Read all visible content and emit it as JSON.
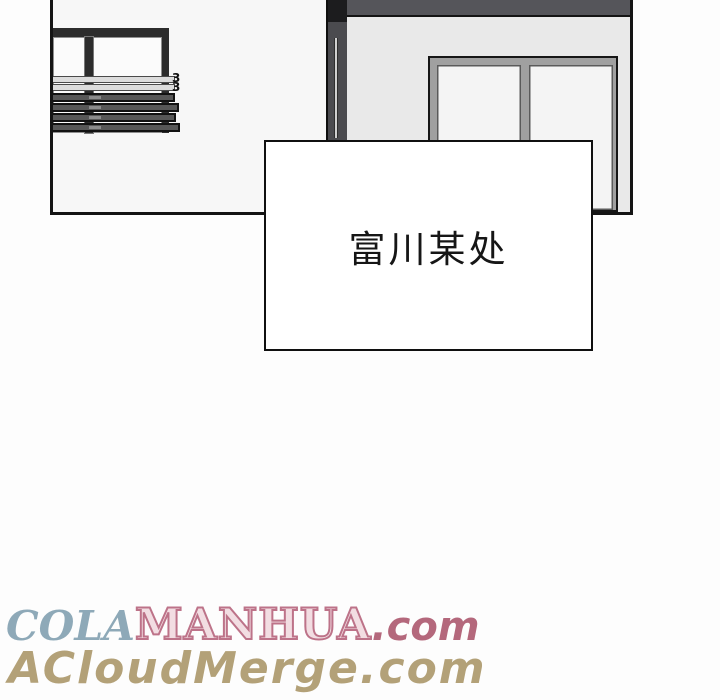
{
  "caption_box": {
    "text": "富川某处"
  },
  "scene": {
    "spring_clip_glyph": "3"
  },
  "watermarks": {
    "line1": {
      "cola": "COLA",
      "cola_color": "#8ea9b8",
      "manhua": "MANHUA",
      "manhua_fill": "#f2dde2",
      "manhua_stroke": "#bd7389",
      "dotcom": ".com",
      "dotcom_color": "#b4687c"
    },
    "line2": {
      "text": "ACloudMerge.com",
      "color": "#b3a178"
    }
  }
}
